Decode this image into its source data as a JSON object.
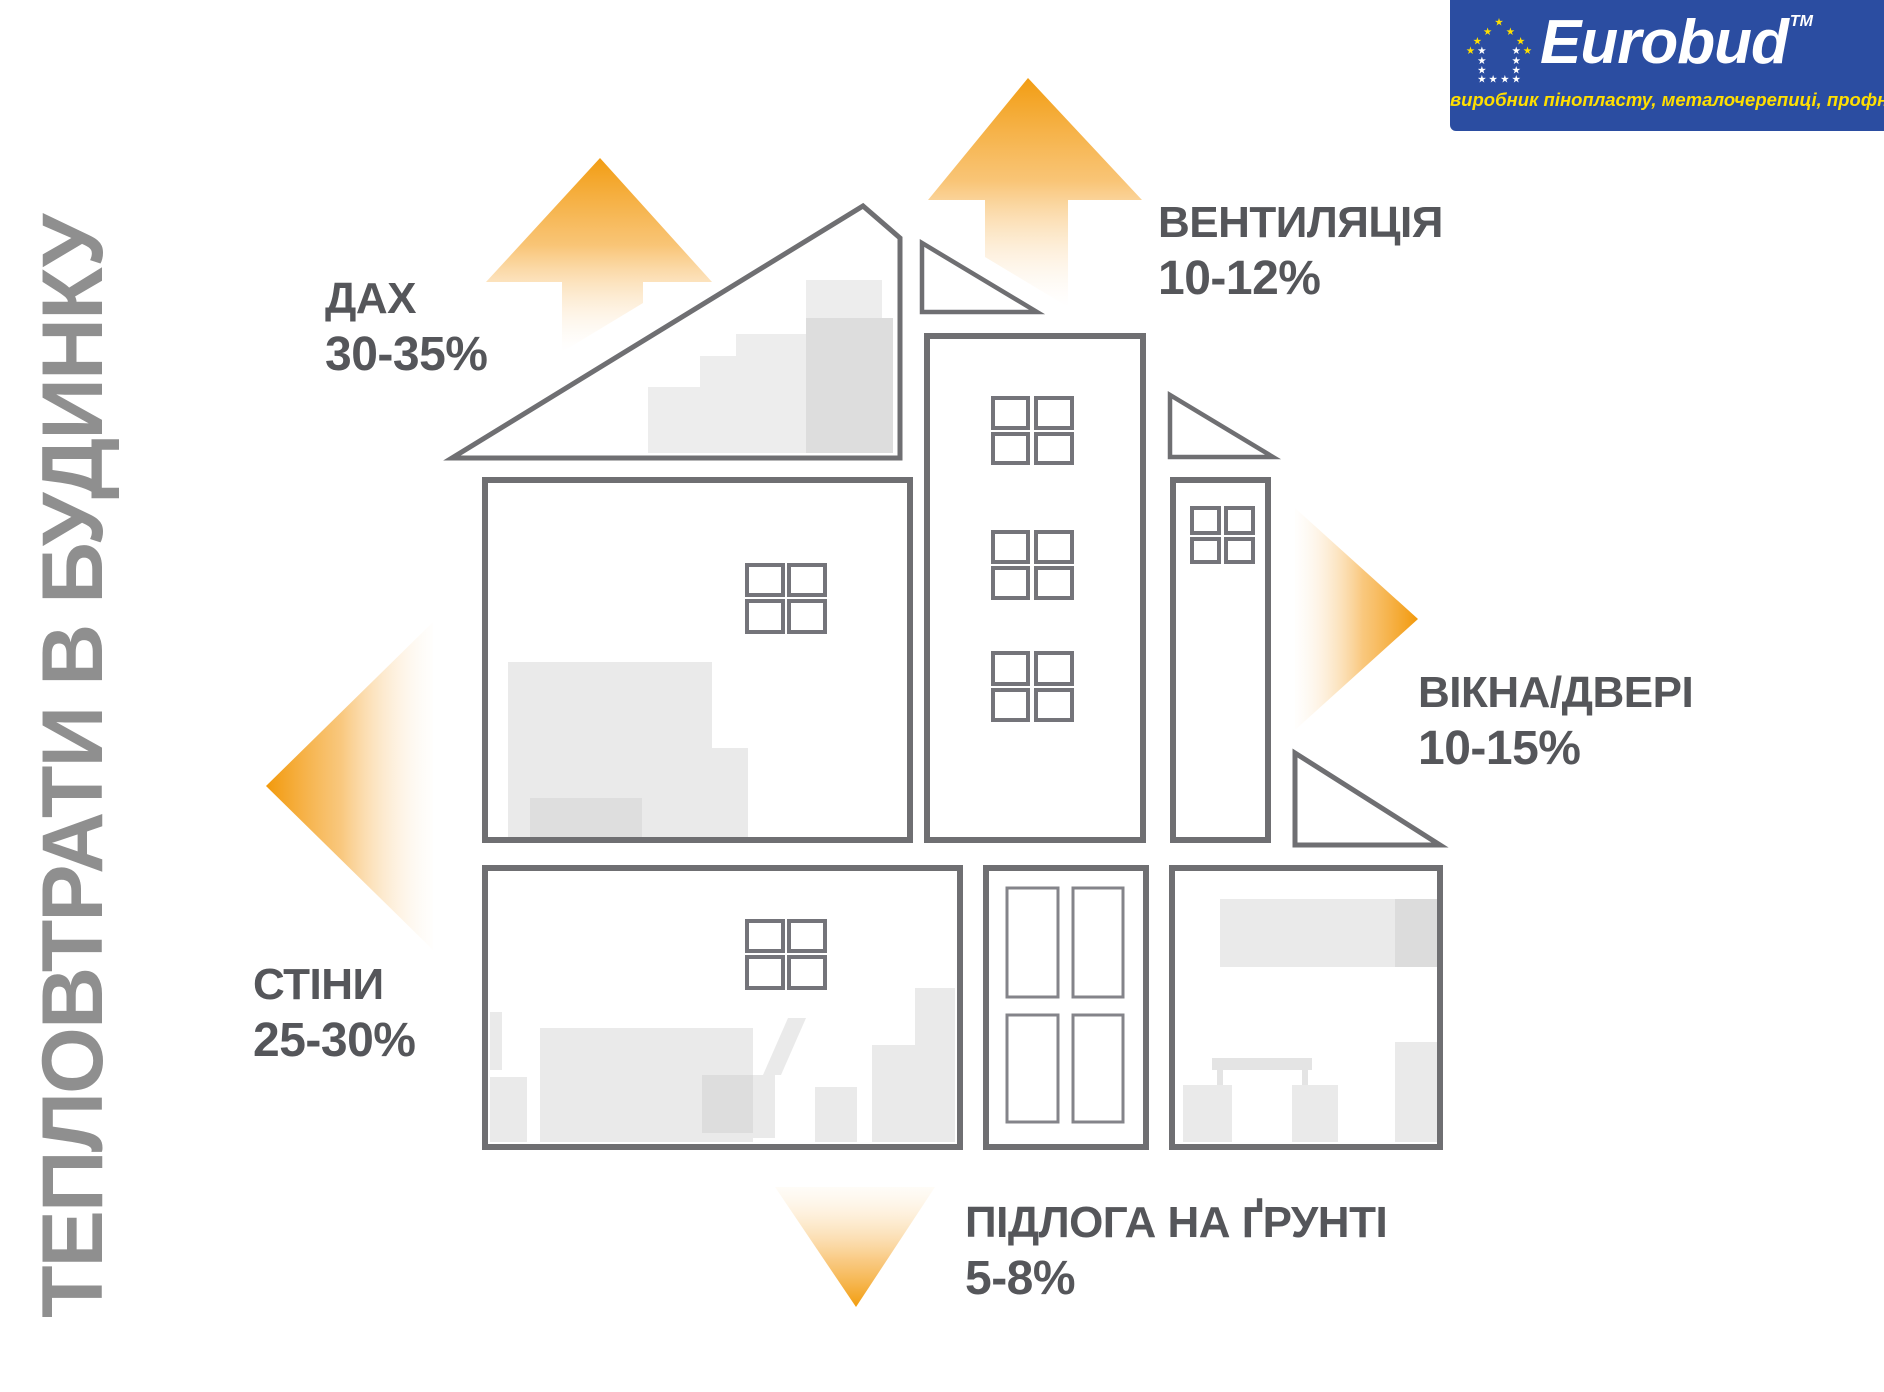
{
  "title": "ТЕПЛОВТРАТИ В БУДИНКУ",
  "logo": {
    "brand": "Eurobud",
    "tm": "TM",
    "tagline": "виробник пінопласту, металочерепиці, профнастилу"
  },
  "labels": {
    "roof": {
      "name": "ДАХ",
      "value": "30-35%"
    },
    "ventilation": {
      "name": "ВЕНТИЛЯЦІЯ",
      "value": "10-12%"
    },
    "windows_doors": {
      "name": "ВІКНА/ДВЕРІ",
      "value": "10-15%"
    },
    "walls": {
      "name": "СТІНИ",
      "value": "25-30%"
    },
    "floor": {
      "name": "ПІДЛОГА НА ҐРУНТІ",
      "value": "5-8%"
    }
  },
  "colors": {
    "arrow_orange": "#F5A01E",
    "house_outline": "#6F6F72",
    "label_text": "#55565A",
    "title_text": "#8F8F8F",
    "logo_blue": "#2B4DA1",
    "logo_yellow": "#FFDF00"
  }
}
